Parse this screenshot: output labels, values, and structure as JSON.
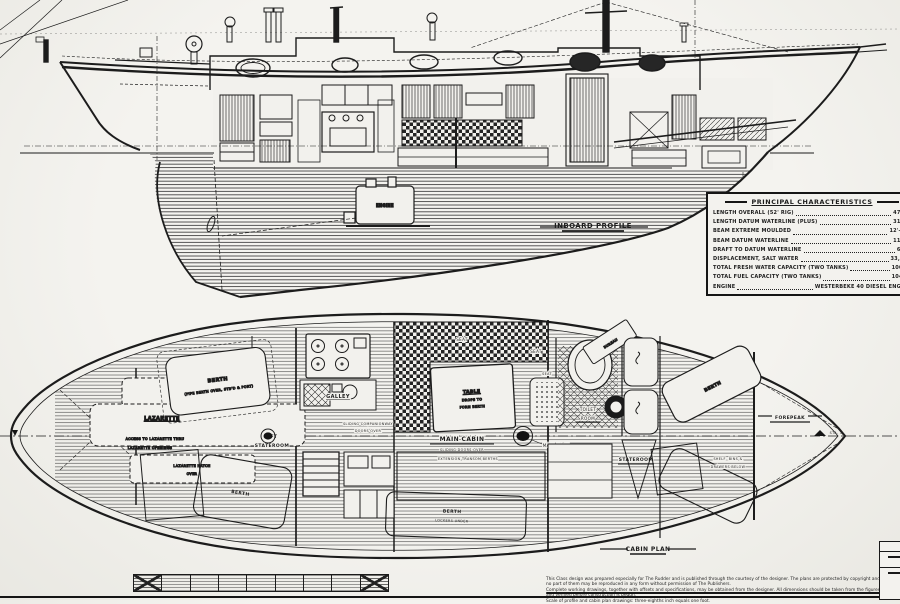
{
  "profile": {
    "caption": "Inboard Profile",
    "engine_label": "Engine"
  },
  "plan": {
    "caption": "Cabin Plan",
    "lazarette": "Lazarette",
    "lazarette_note1": "Access To Lazarette Thru",
    "lazarette_note2": "Lazarette Openings",
    "lazarette_hatch1": "Lazarette Hatch",
    "lazarette_hatch2": "Over",
    "aft_berth": "Berth",
    "aft_berth_note": "(Pipe Berth Over, Stb'd & Port)",
    "aft_stateroom1": "Aft",
    "aft_stateroom2": "Stateroom",
    "galley": "Galley",
    "companionway1": "Sliding Companionway",
    "companionway2": "Doors Over",
    "main_cabin": "Main Cabin",
    "main_cabin_sub": "Sliding Doors Over",
    "main_cabin_sub2": "Extension Transom Berths",
    "table1": "Table",
    "table2": "Drops To",
    "table3": "Form Berth",
    "seat": "Seat",
    "main_mast": "Main Mast",
    "toilet1": "Toilet",
    "toilet2": "Room",
    "bureau": "Bureau",
    "stateroom": "Stateroom",
    "fwd_berth": "Berth",
    "shelf_note1": "Shelf, Bins &",
    "shelf_note2": "Drawers Below",
    "forepeak": "Forepeak",
    "lower_berth": "Berth",
    "lower_berth_sub": "Lockers Under",
    "port_lower_berth": "Berth",
    "sta_bow": "Sta. 1"
  },
  "characteristics": {
    "title": "Principal Characteristics",
    "rows": [
      {
        "label": "Length Overall (52' Rig)",
        "value": "47'-8\""
      },
      {
        "label": "Length Datum Waterline (Plus)",
        "value": "31'-9\""
      },
      {
        "label": "Beam Extreme Moulded",
        "value": "12'-10\""
      },
      {
        "label": "Beam Datum Waterline",
        "value": "11'-6\""
      },
      {
        "label": "Draft To Datum Waterline",
        "value": "6'-6\""
      },
      {
        "label": "Displacement, Salt Water",
        "value": "33,500"
      },
      {
        "label": "Total Fresh Water Capacity (Two Tanks)",
        "value": "100 G."
      },
      {
        "label": "Total Fuel Capacity (Two Tanks)",
        "value": "104 G."
      },
      {
        "label": "Engine",
        "value": "Westerbeke 40 Diesel Engine"
      }
    ]
  },
  "footer": {
    "line1": "This Class design was prepared especially for The Rudder and is published through the courtesy of the designer. The plans are protected by copyright and no part of them may be reproduced in any form without permission of The Publishers.",
    "line2": "Complete working drawings, together with offsets and specifications, may be obtained from the designer. All dimensions should be taken from the figures and verified before construction is begun.",
    "line3": "Scale of profile and cabin plan drawings: three-eighths inch equals one foot."
  }
}
